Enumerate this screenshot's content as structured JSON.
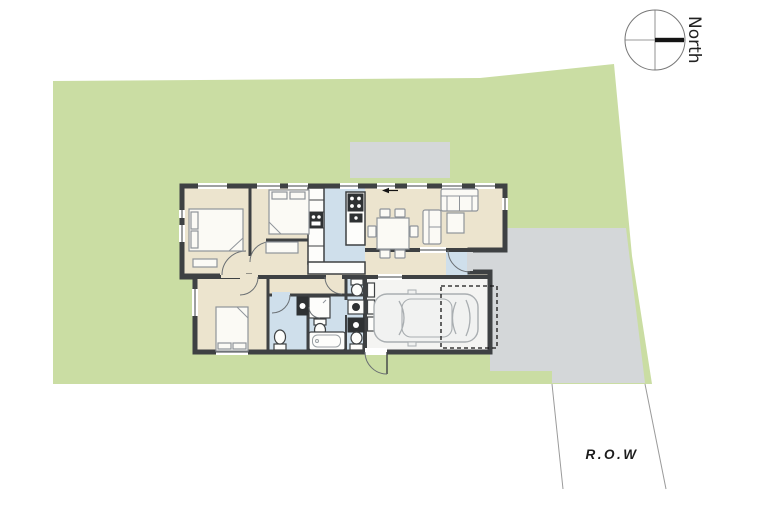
{
  "compass": {
    "label": "North"
  },
  "row": {
    "label": "R.O.W"
  },
  "colors": {
    "background": "#ffffff",
    "lot_green": "#cadda3",
    "concrete_gray": "#d4d7d9",
    "floor_beige": "#ece4ce",
    "floor_blue": "#cfdfeb",
    "garage_floor": "#f4f4f2",
    "wall_dark": "#3e4143",
    "north_bar": "#141414",
    "boundary_line": "#9a9a9a"
  }
}
